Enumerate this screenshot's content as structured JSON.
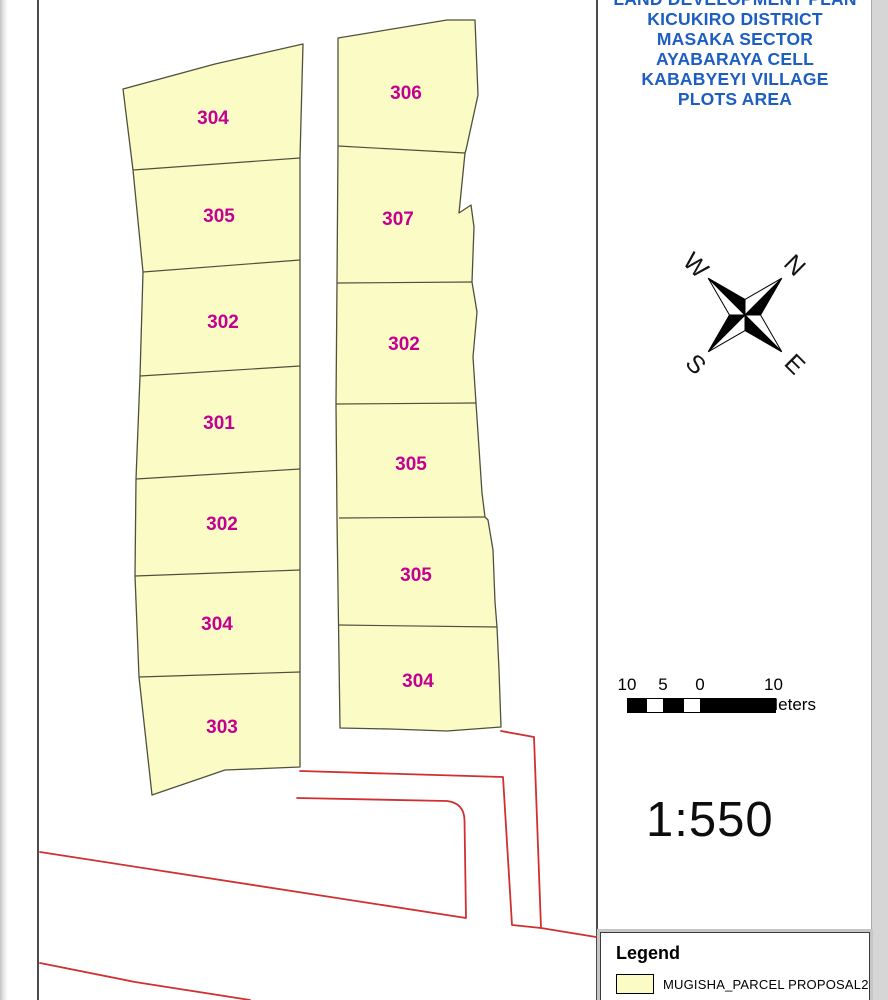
{
  "title_block": {
    "lines": [
      "LAND DEVELOPMENT PLAN",
      "KICUKIRO DISTRICT",
      "MASAKA SECTOR",
      "AYABARAYA CELL",
      "KABABYEYI VILLAGE",
      "PLOTS AREA"
    ],
    "text_color": "#1d5ec2"
  },
  "compass": {
    "north": "N",
    "east": "E",
    "south": "S",
    "west": "W"
  },
  "scale_bar": {
    "tick_labels": [
      "10",
      "5",
      "0"
    ],
    "right_label": "10 Meters"
  },
  "scale_ratio": "1:550",
  "legend": {
    "title": "Legend",
    "items": [
      {
        "label": "MUGISHA_PARCEL PROPOSAL2",
        "swatch_color": "#fbfbc6"
      }
    ]
  },
  "map": {
    "parcel_fill": "#fbfbc6",
    "parcel_stroke": "#50503e",
    "plot_label_color": "#c40091",
    "road_color": "#d03030",
    "blocks": [
      {
        "name": "west block",
        "plots": [
          "304",
          "305",
          "302",
          "301",
          "302",
          "304",
          "303"
        ]
      },
      {
        "name": "east block",
        "plots": [
          "306",
          "307",
          "302",
          "305",
          "305",
          "304"
        ]
      }
    ]
  }
}
